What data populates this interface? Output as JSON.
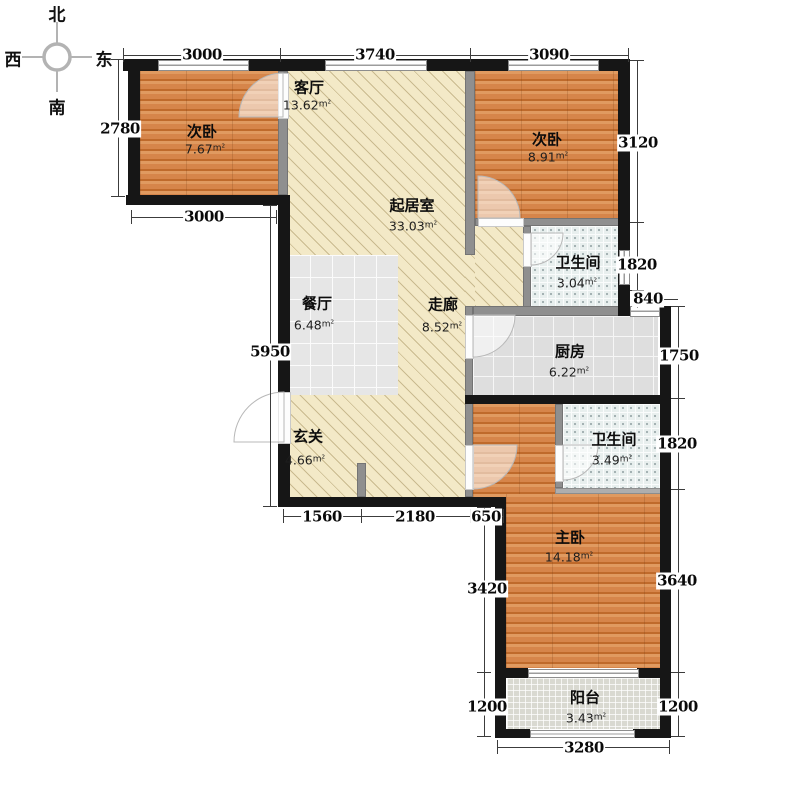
{
  "meta": {
    "area_unit": "m²"
  },
  "compass": {
    "north": "北",
    "south": "南",
    "west": "西",
    "east": "东"
  },
  "rooms": [
    {
      "id": "bedroom-left",
      "name": "次卧",
      "area": "7.67"
    },
    {
      "id": "living",
      "name": "客厅",
      "area": "13.62"
    },
    {
      "id": "sitting",
      "name": "起居室",
      "area": "33.03"
    },
    {
      "id": "bedroom-right",
      "name": "次卧",
      "area": "8.91"
    },
    {
      "id": "bath-upper",
      "name": "卫生间",
      "area": "3.04"
    },
    {
      "id": "dining",
      "name": "餐厅",
      "area": "6.48"
    },
    {
      "id": "corridor",
      "name": "走廊",
      "area": "8.52"
    },
    {
      "id": "kitchen",
      "name": "厨房",
      "area": "6.22"
    },
    {
      "id": "foyer",
      "name": "玄关",
      "area": "4.66"
    },
    {
      "id": "bath-lower",
      "name": "卫生间",
      "area": "3.49"
    },
    {
      "id": "master",
      "name": "主卧",
      "area": "14.18"
    },
    {
      "id": "balcony",
      "name": "阳台",
      "area": "3.43"
    }
  ],
  "dimensions": {
    "top": [
      "3000",
      "3740",
      "3090"
    ],
    "left": {
      "bedroom_height": "2780",
      "bedroom_width": "3000",
      "hall_height": "5950"
    },
    "bottom": {
      "hall": [
        "1560",
        "2180",
        "650"
      ],
      "balcony": "3280"
    },
    "right": {
      "upper": [
        "3120",
        "1820",
        "840"
      ],
      "outer": [
        "1750",
        "1820",
        "3640",
        "1200"
      ]
    },
    "lower_left": {
      "master_height": "3420",
      "balcony_height": "1200"
    }
  },
  "colors": {
    "wood_floor": "#d6854a",
    "hatch_floor": "#f3e9c7",
    "tile_gray": "#e3e3e3",
    "tile_bath": "#e8efee",
    "tile_balcony": "#d9d9d1",
    "wall": "#161616",
    "partition": "#8f8f8f"
  }
}
